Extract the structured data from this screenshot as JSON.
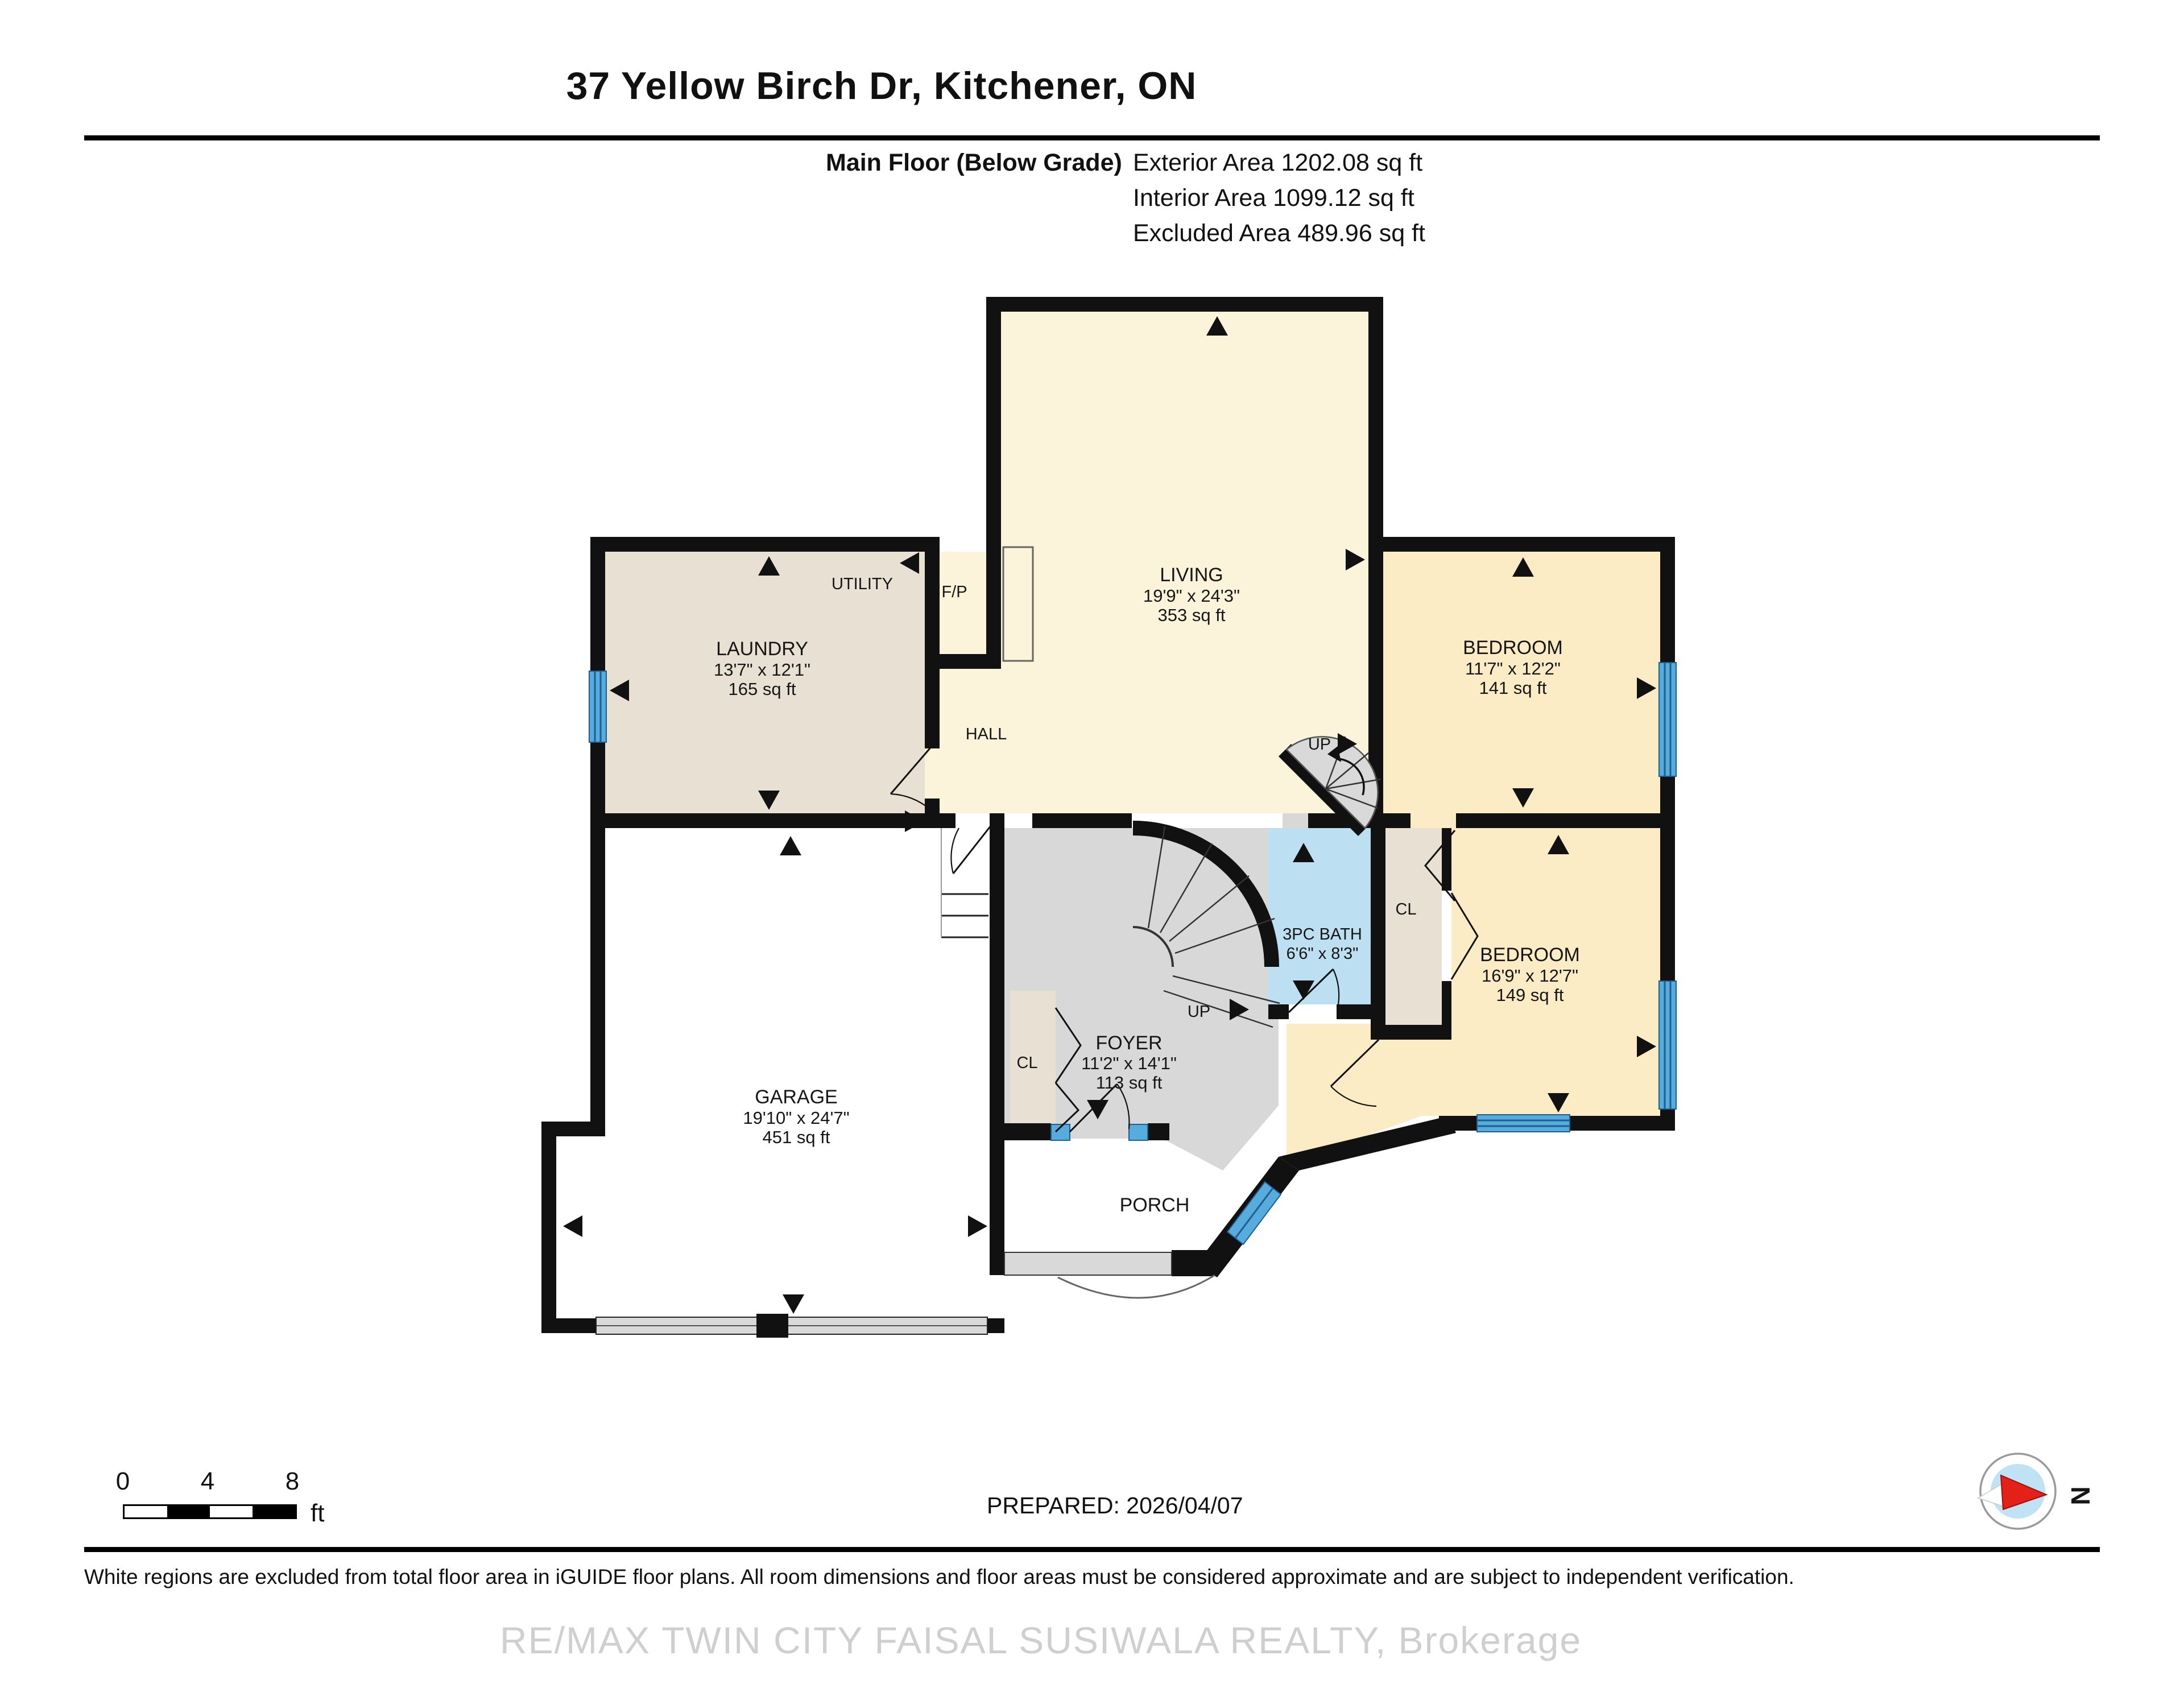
{
  "header": {
    "title": "37 Yellow Birch Dr, Kitchener, ON",
    "floor_label": "Main Floor (Below Grade)",
    "areas": [
      "Exterior Area 1202.08 sq ft",
      "Interior Area 1099.12 sq ft",
      "Excluded Area 489.96 sq ft"
    ]
  },
  "rooms": {
    "living": {
      "name": "LIVING",
      "dims": "19'9\" x 24'3\"",
      "area": "353 sq ft"
    },
    "bedroom1": {
      "name": "BEDROOM",
      "dims": "11'7\" x 12'2\"",
      "area": "141 sq ft"
    },
    "bedroom2": {
      "name": "BEDROOM",
      "dims": "16'9\" x 12'7\"",
      "area": "149 sq ft"
    },
    "laundry": {
      "name": "LAUNDRY",
      "dims": "13'7\" x 12'1\"",
      "area": "165 sq ft"
    },
    "garage": {
      "name": "GARAGE",
      "dims": "19'10\" x 24'7\"",
      "area": "451 sq ft"
    },
    "foyer": {
      "name": "FOYER",
      "dims": "11'2\" x 14'1\"",
      "area": "113 sq ft"
    },
    "bath": {
      "name": "3PC BATH",
      "dims": "6'6\" x 8'3\""
    },
    "utility": "UTILITY",
    "fireplace": "F/P",
    "hall": "HALL",
    "porch": "PORCH",
    "closet": "CL",
    "up": "UP"
  },
  "scale_bar": {
    "ticks": [
      "0",
      "4",
      "8"
    ],
    "unit": "ft"
  },
  "compass": {
    "north": "N"
  },
  "footer": {
    "prepared": "PREPARED: 2026/04/07",
    "disclaimer": "White regions are excluded from total floor area in iGUIDE floor plans. All room dimensions and floor areas must be considered approximate and are subject to independent verification.",
    "watermark": "RE/MAX TWIN CITY FAISAL SUSIWALA REALTY, Brokerage"
  },
  "colors": {
    "wall": "#111111",
    "living": "#fbf3da",
    "bedroom": "#fbecc5",
    "laundry": "#e7e0d3",
    "foyer": "#d8d8d8",
    "bath": "#bcdff2",
    "window": "#57abdd",
    "excluded": "#ffffff"
  }
}
